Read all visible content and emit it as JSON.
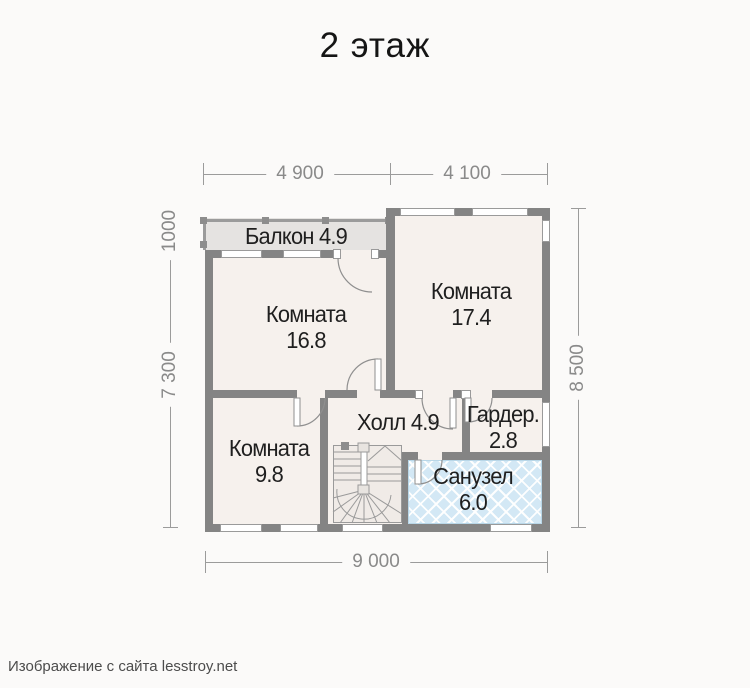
{
  "title": "2 этаж",
  "footer": "Изображение с сайта lesstroy.net",
  "rooms": {
    "balcony": {
      "label": "Балкон 4.9"
    },
    "room168": {
      "name": "Комната",
      "area": "16.8"
    },
    "room174": {
      "name": "Комната",
      "area": "17.4"
    },
    "room98": {
      "name": "Комната",
      "area": "9.8"
    },
    "hall": {
      "label": "Холл 4.9"
    },
    "wardrobe": {
      "name": "Гардер.",
      "area": "2.8"
    },
    "bathroom": {
      "name": "Санузел",
      "area": "6.0"
    }
  },
  "dims": {
    "top_left": "4 900",
    "top_right": "4 100",
    "left_upper": "1000",
    "left_lower": "7 300",
    "right": "8 500",
    "bottom": "9 000"
  },
  "colors": {
    "wall": "#848484",
    "room_floor": "#f6f1ed",
    "balcony_floor": "#e5e3e1",
    "bathroom_tile": "#d3e8f5",
    "dimension": "#8a8a8a"
  }
}
